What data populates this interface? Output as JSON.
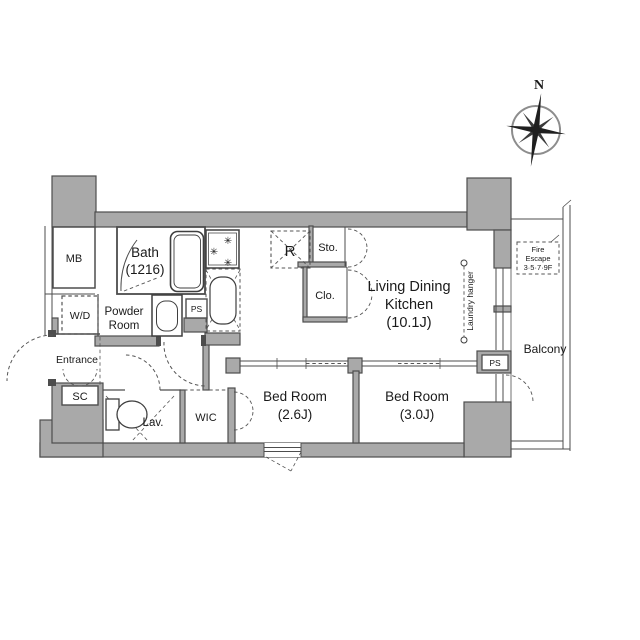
{
  "compass": {
    "north": "N"
  },
  "rooms": {
    "mb": {
      "label": "MB"
    },
    "bath": {
      "label": "Bath",
      "size": "(1216)"
    },
    "powder_room": {
      "line1": "Powder",
      "line2": "Room"
    },
    "wd": {
      "label": "W/D"
    },
    "entrance": {
      "label": "Entrance"
    },
    "sc": {
      "label": "SC"
    },
    "lav": {
      "label": "Lav."
    },
    "wic": {
      "label": "WIC"
    },
    "bedroom_1": {
      "label": "Bed Room",
      "size": "(2.6J)"
    },
    "bedroom_2": {
      "label": "Bed Room",
      "size": "(3.0J)"
    },
    "ldk": {
      "line1": "Living Dining",
      "line2": "Kitchen",
      "size": "(10.1J)"
    },
    "storage": {
      "label": "Sto."
    },
    "closet": {
      "label": "Clo."
    },
    "refrigerator": {
      "label": "R"
    },
    "ps_kitchen": {
      "label": "PS"
    },
    "ps_balcony": {
      "label": "PS"
    },
    "balcony": {
      "label": "Balcony"
    }
  },
  "annotations": {
    "laundry_hanger": "Laundry hanger",
    "fire_escape": {
      "line1": "Fire",
      "line2": "Escape",
      "line3": "3·5·7·9F"
    }
  },
  "colors": {
    "wall_fill": "#a9a9a9",
    "wall_stroke": "#4d4d4d",
    "line": "#333333",
    "background": "#ffffff"
  }
}
